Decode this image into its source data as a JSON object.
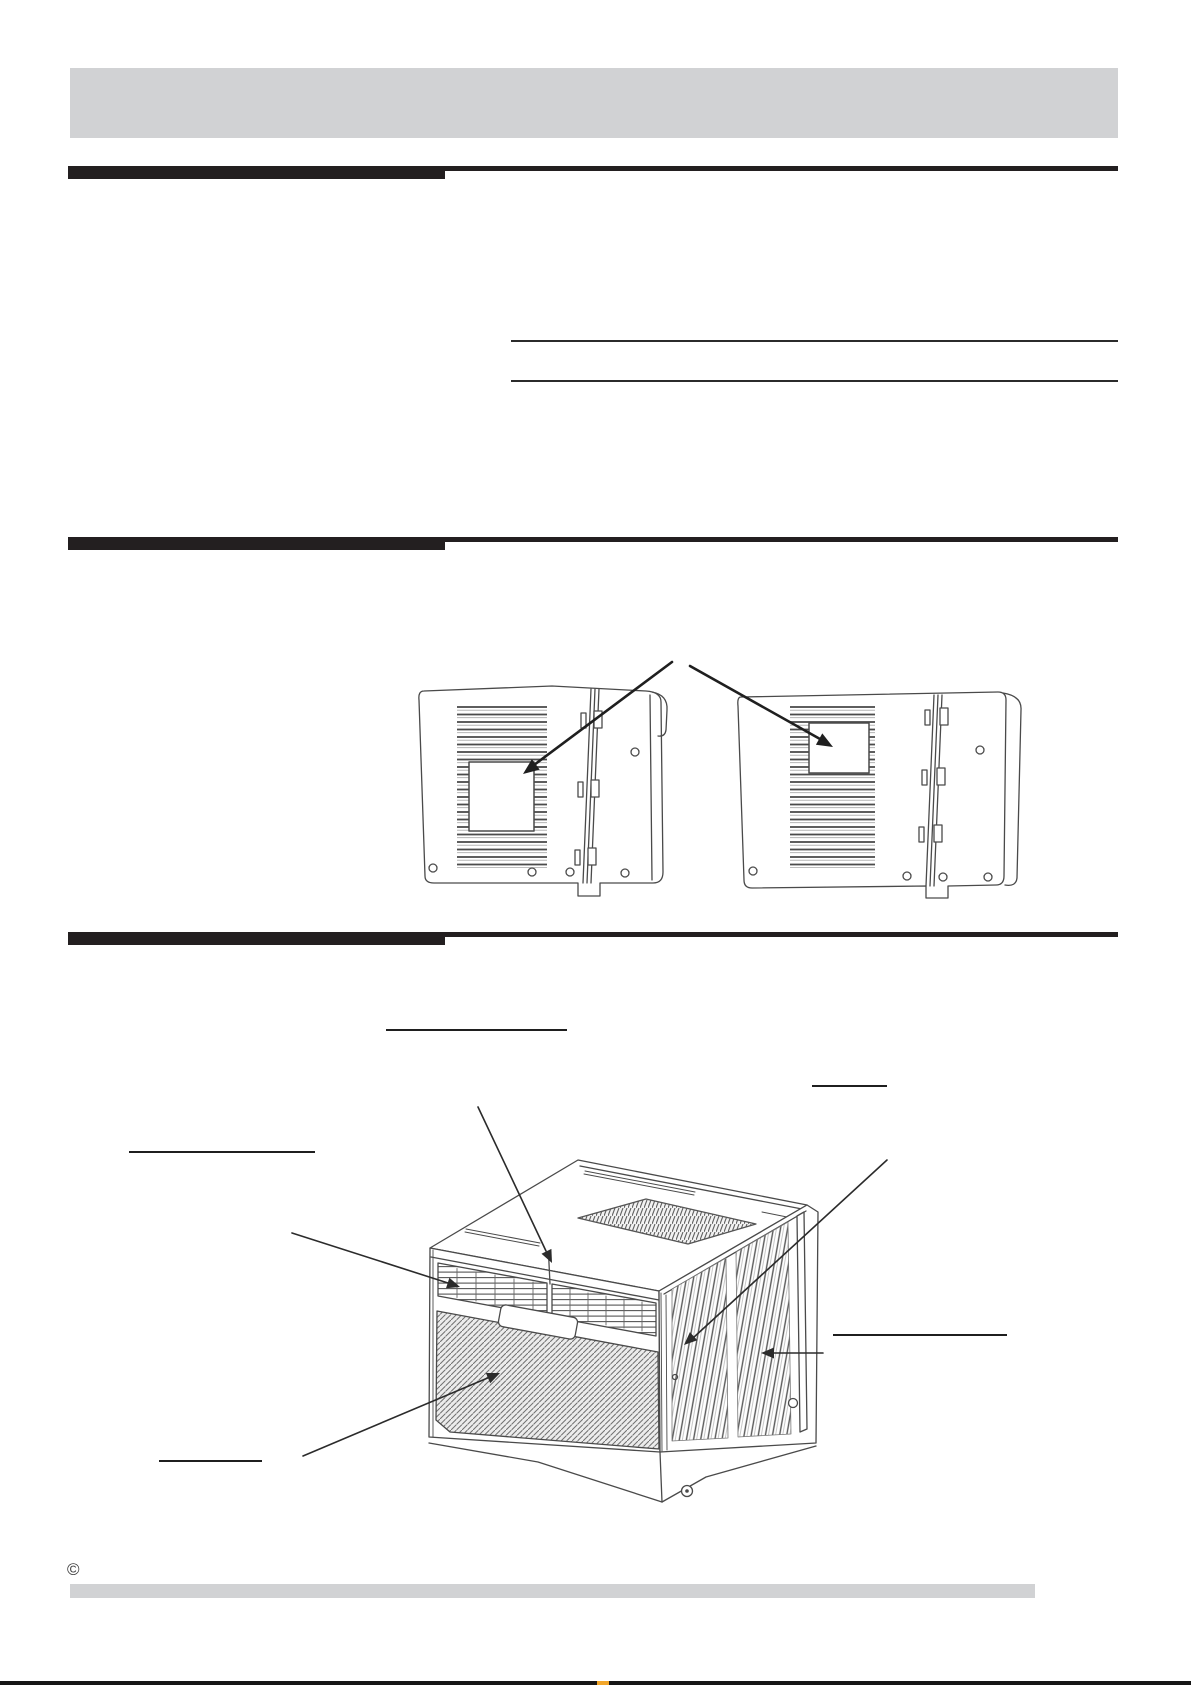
{
  "colors": {
    "page_bg": "#ffffff",
    "band_gray": "#d1d2d4",
    "bar_black": "#231f20",
    "rule_black": "#2b2b2b",
    "underline_black": "#1f1f1f",
    "drawing_stroke": "#4a4a4a",
    "callout_stroke": "#2b2b2b",
    "edge_black": "#161616",
    "accent_orange": "#f2a629"
  },
  "footer": {
    "copyright_symbol": "©"
  }
}
